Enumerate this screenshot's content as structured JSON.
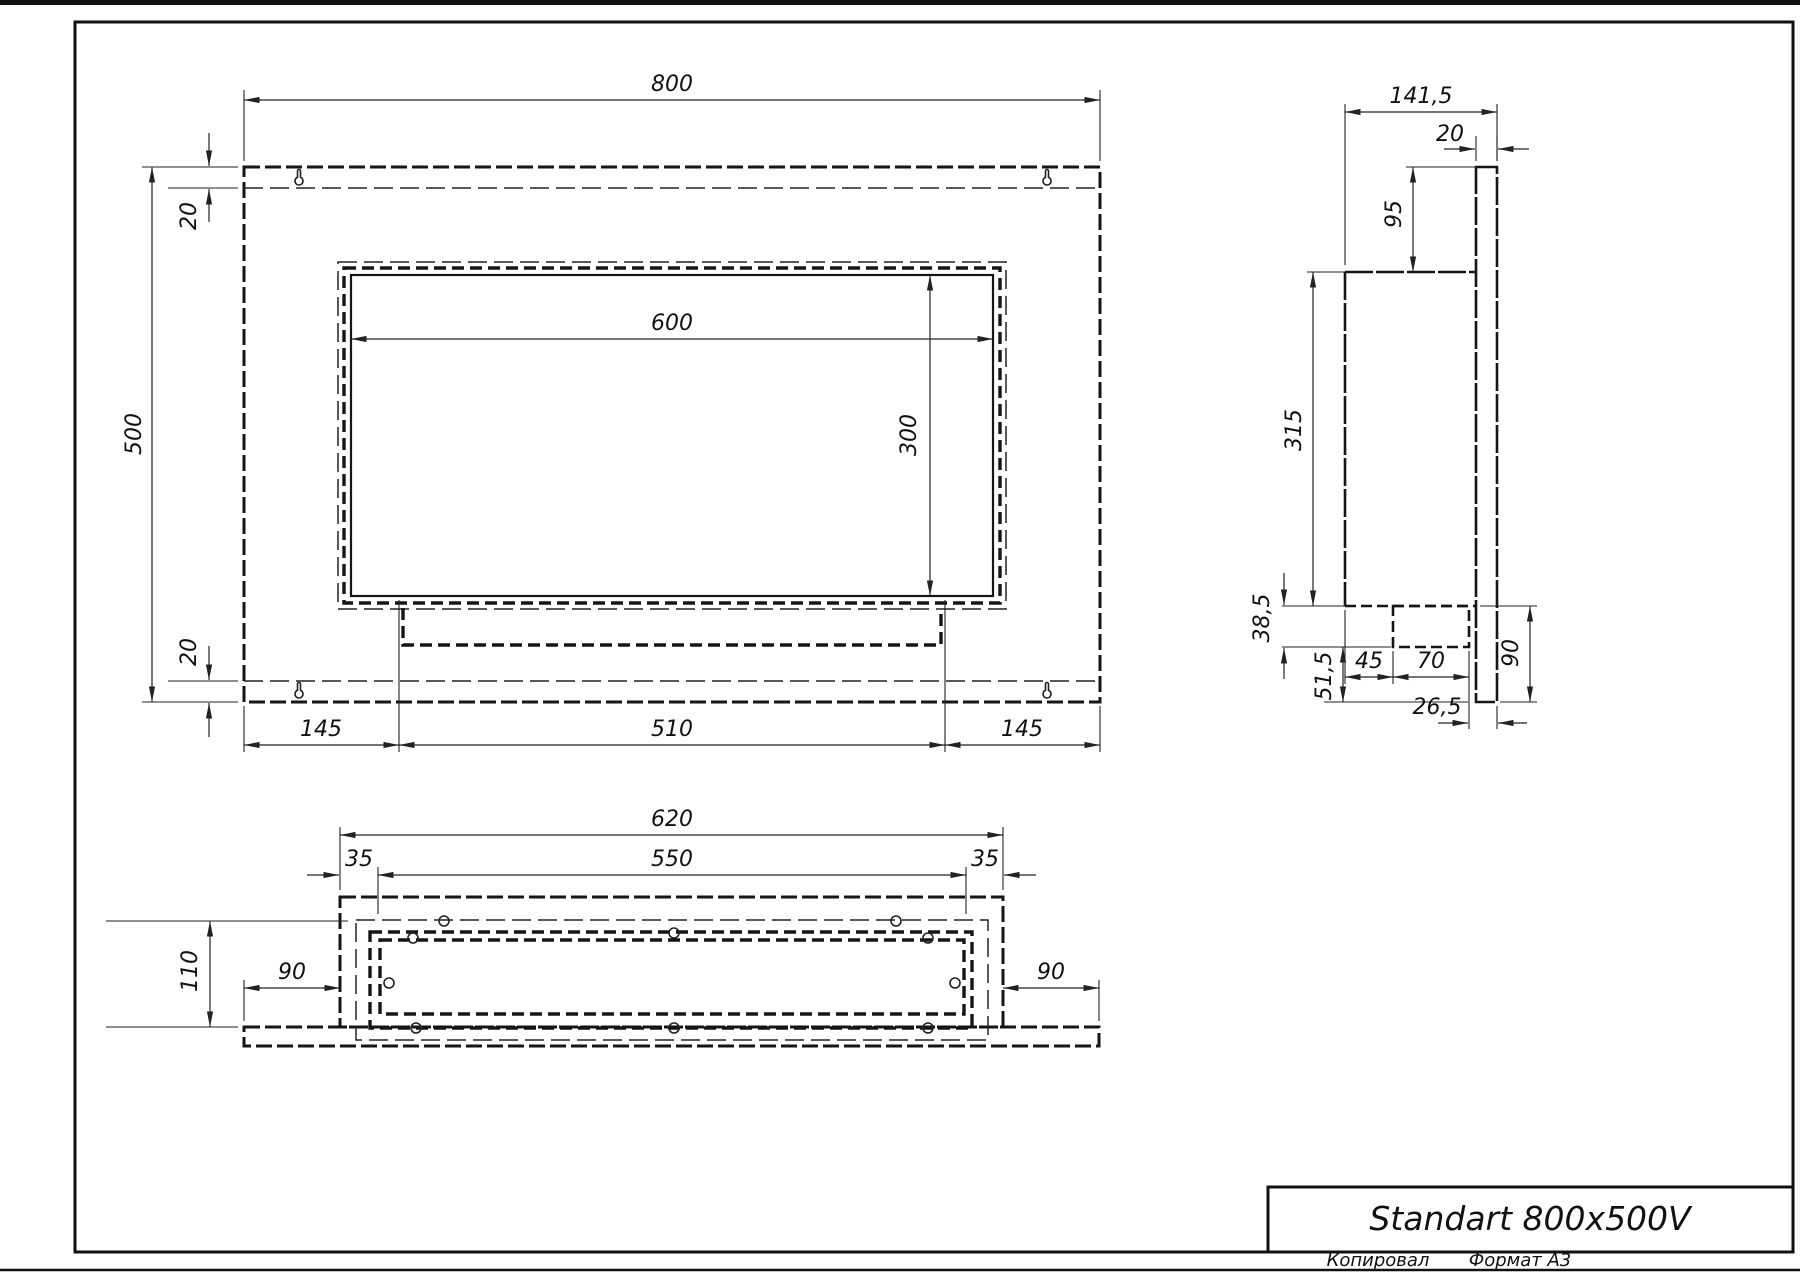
{
  "page": {
    "footer": {
      "copied_label": "Копировал",
      "format_label": "Формат А3"
    }
  },
  "title_block": {
    "product_title": "Standart 800x500V"
  },
  "front_view": {
    "dims": {
      "overall_width": "800",
      "overall_height": "500",
      "top_flange": "20",
      "bottom_flange": "20",
      "opening_width": "600",
      "opening_height": "300",
      "left_offset": "145",
      "tray_width": "510",
      "right_offset": "145"
    }
  },
  "side_view": {
    "dims": {
      "overall_depth": "141,5",
      "back_panel_thickness": "20",
      "top_extension": "95",
      "body_height": "315",
      "burner_drop": "38,5",
      "bottom_clearance": "51,5",
      "front_inset": "45",
      "burner_depth": "70",
      "back_clearance": "26,5",
      "bottom_extension": "90"
    }
  },
  "bottom_view": {
    "dims": {
      "body_width": "620",
      "inner_width": "550",
      "left_inset": "35",
      "right_inset": "35",
      "overall_depth": "110",
      "left_extension": "90",
      "right_extension": "90"
    }
  }
}
